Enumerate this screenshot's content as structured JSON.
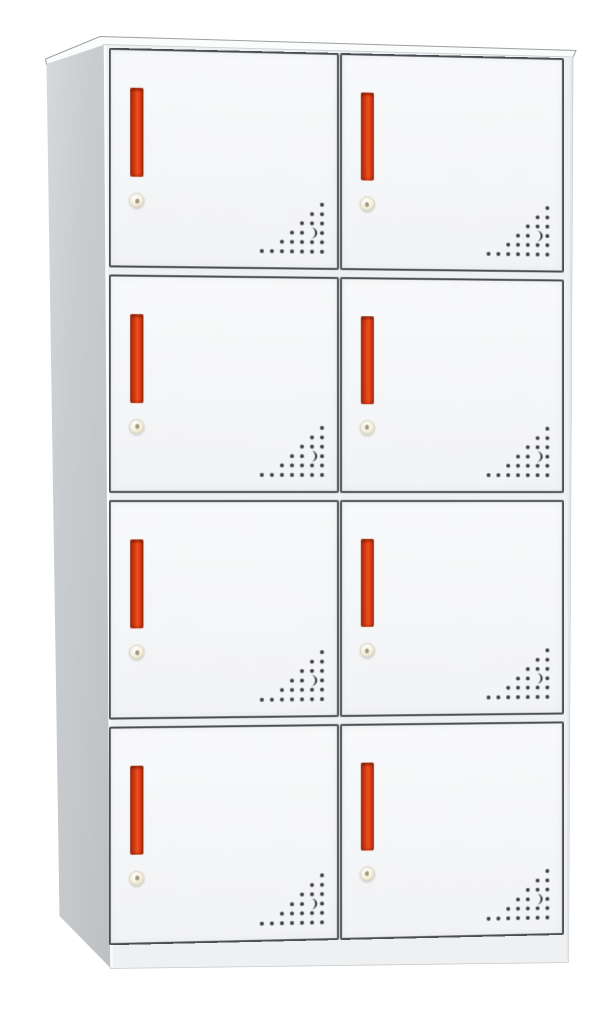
{
  "meta": {
    "description": "Product render of a light-grey 8-door steel locker cabinet on a plain white background, shown in slight perspective with the left side panel visible",
    "background": "#ffffff"
  },
  "theme": {
    "bg": "#ffffff",
    "top_face": "#fbfcfc",
    "top_outline": "#9ca1a4",
    "side_from": "#c9cdd0",
    "side_to": "#bdc1c4",
    "side_tip": "#d6d9db",
    "body_frame": "#eef0f2",
    "body_frame_edge": "#c7cbcd",
    "front_edge_highlight": "#fbfcfd",
    "door_face_top": "#f8f9fa",
    "door_face_bottom": "#f2f3f5",
    "door_border": "#4a4e52",
    "handle_edge_dark": "#8f2a10",
    "handle_red": "#d83a12",
    "handle_red_bright": "#ef5422",
    "lock_face": "#f5efdc",
    "lock_rim": "#cfc8b2",
    "lock_pin": "#8a7f62",
    "vent_dot": "#3c4043"
  },
  "cabinet": {
    "rows": 4,
    "columns": 2,
    "door_count": 8,
    "doors": [
      {
        "id": "door-1",
        "row": 1,
        "column": "left"
      },
      {
        "id": "door-2",
        "row": 1,
        "column": "right"
      },
      {
        "id": "door-3",
        "row": 2,
        "column": "left"
      },
      {
        "id": "door-4",
        "row": 2,
        "column": "right"
      },
      {
        "id": "door-5",
        "row": 3,
        "column": "left"
      },
      {
        "id": "door-6",
        "row": 3,
        "column": "right"
      },
      {
        "id": "door-7",
        "row": 4,
        "column": "left"
      },
      {
        "id": "door-8",
        "row": 4,
        "column": "right"
      }
    ],
    "door_parts": {
      "handle": "vertical recessed red pull bar",
      "lock": "round brass cam lock below handle",
      "vents": "triangular cluster of perforation holes in bottom-right corner"
    },
    "vent_pattern": {
      "rows_top_to_bottom": [
        1,
        2,
        3,
        4,
        5,
        7
      ],
      "right_aligned_x": 62,
      "col_spacing": 10,
      "row_spacing": 9.4,
      "first_row_y": 5,
      "dot_radius": 2,
      "crescent_row_index": 3,
      "crescent_index_from_right": 1
    }
  }
}
